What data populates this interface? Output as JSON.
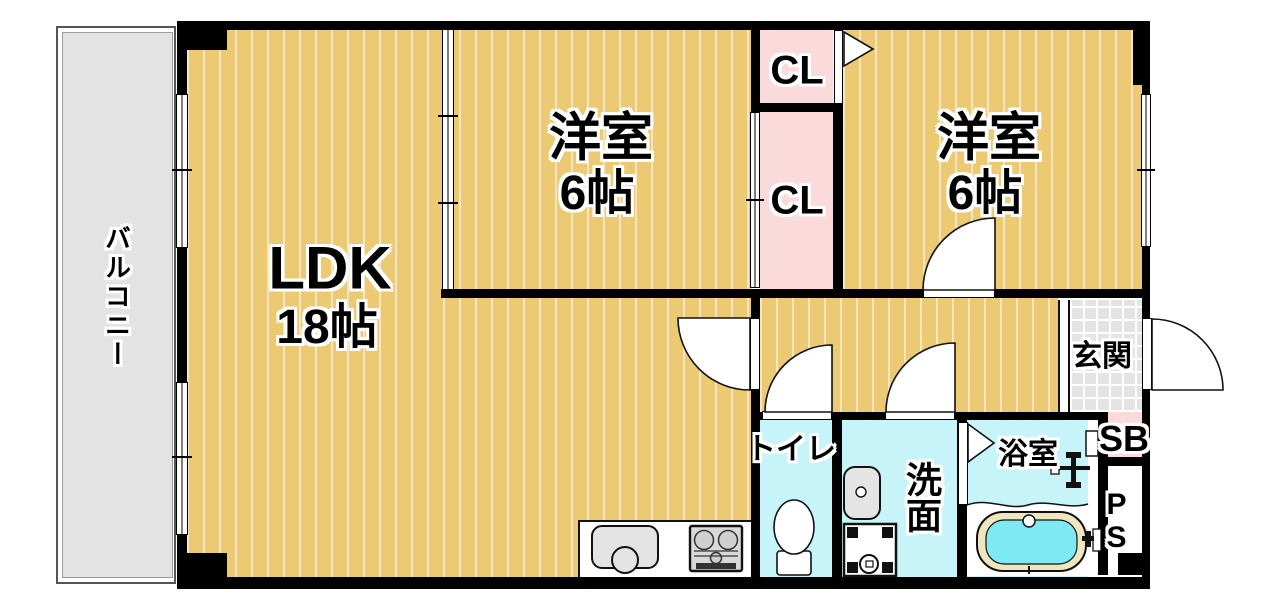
{
  "plan": {
    "type": "apartment-floor-plan",
    "layout_name": "2LDK"
  },
  "rooms": {
    "balcony": {
      "label": "バルコニー"
    },
    "ldk": {
      "name": "LDK",
      "size": "18帖"
    },
    "bedroom_top": {
      "name": "洋室",
      "size": "6帖"
    },
    "bedroom_right": {
      "name": "洋室",
      "size": "6帖"
    },
    "closet_upper": {
      "label": "CL"
    },
    "closet_lower": {
      "label": "CL"
    },
    "entrance": {
      "label": "玄関"
    },
    "toilet": {
      "label": "トイレ"
    },
    "washroom": {
      "label": "洗面"
    },
    "bathroom": {
      "label": "浴室"
    },
    "shoe_box": {
      "label": "SB"
    },
    "pipe_space": {
      "label": "PS"
    }
  },
  "colors": {
    "wall": "#000000",
    "wood_floor": "#ecc973",
    "wet_area": "#c7f4f8",
    "closet": "#fbdadb",
    "entrance_tile": "#e4e4e4",
    "balcony": "#e3e3e3",
    "bath_water": "#7de9f2",
    "tub_rim": "#eee6bd"
  }
}
